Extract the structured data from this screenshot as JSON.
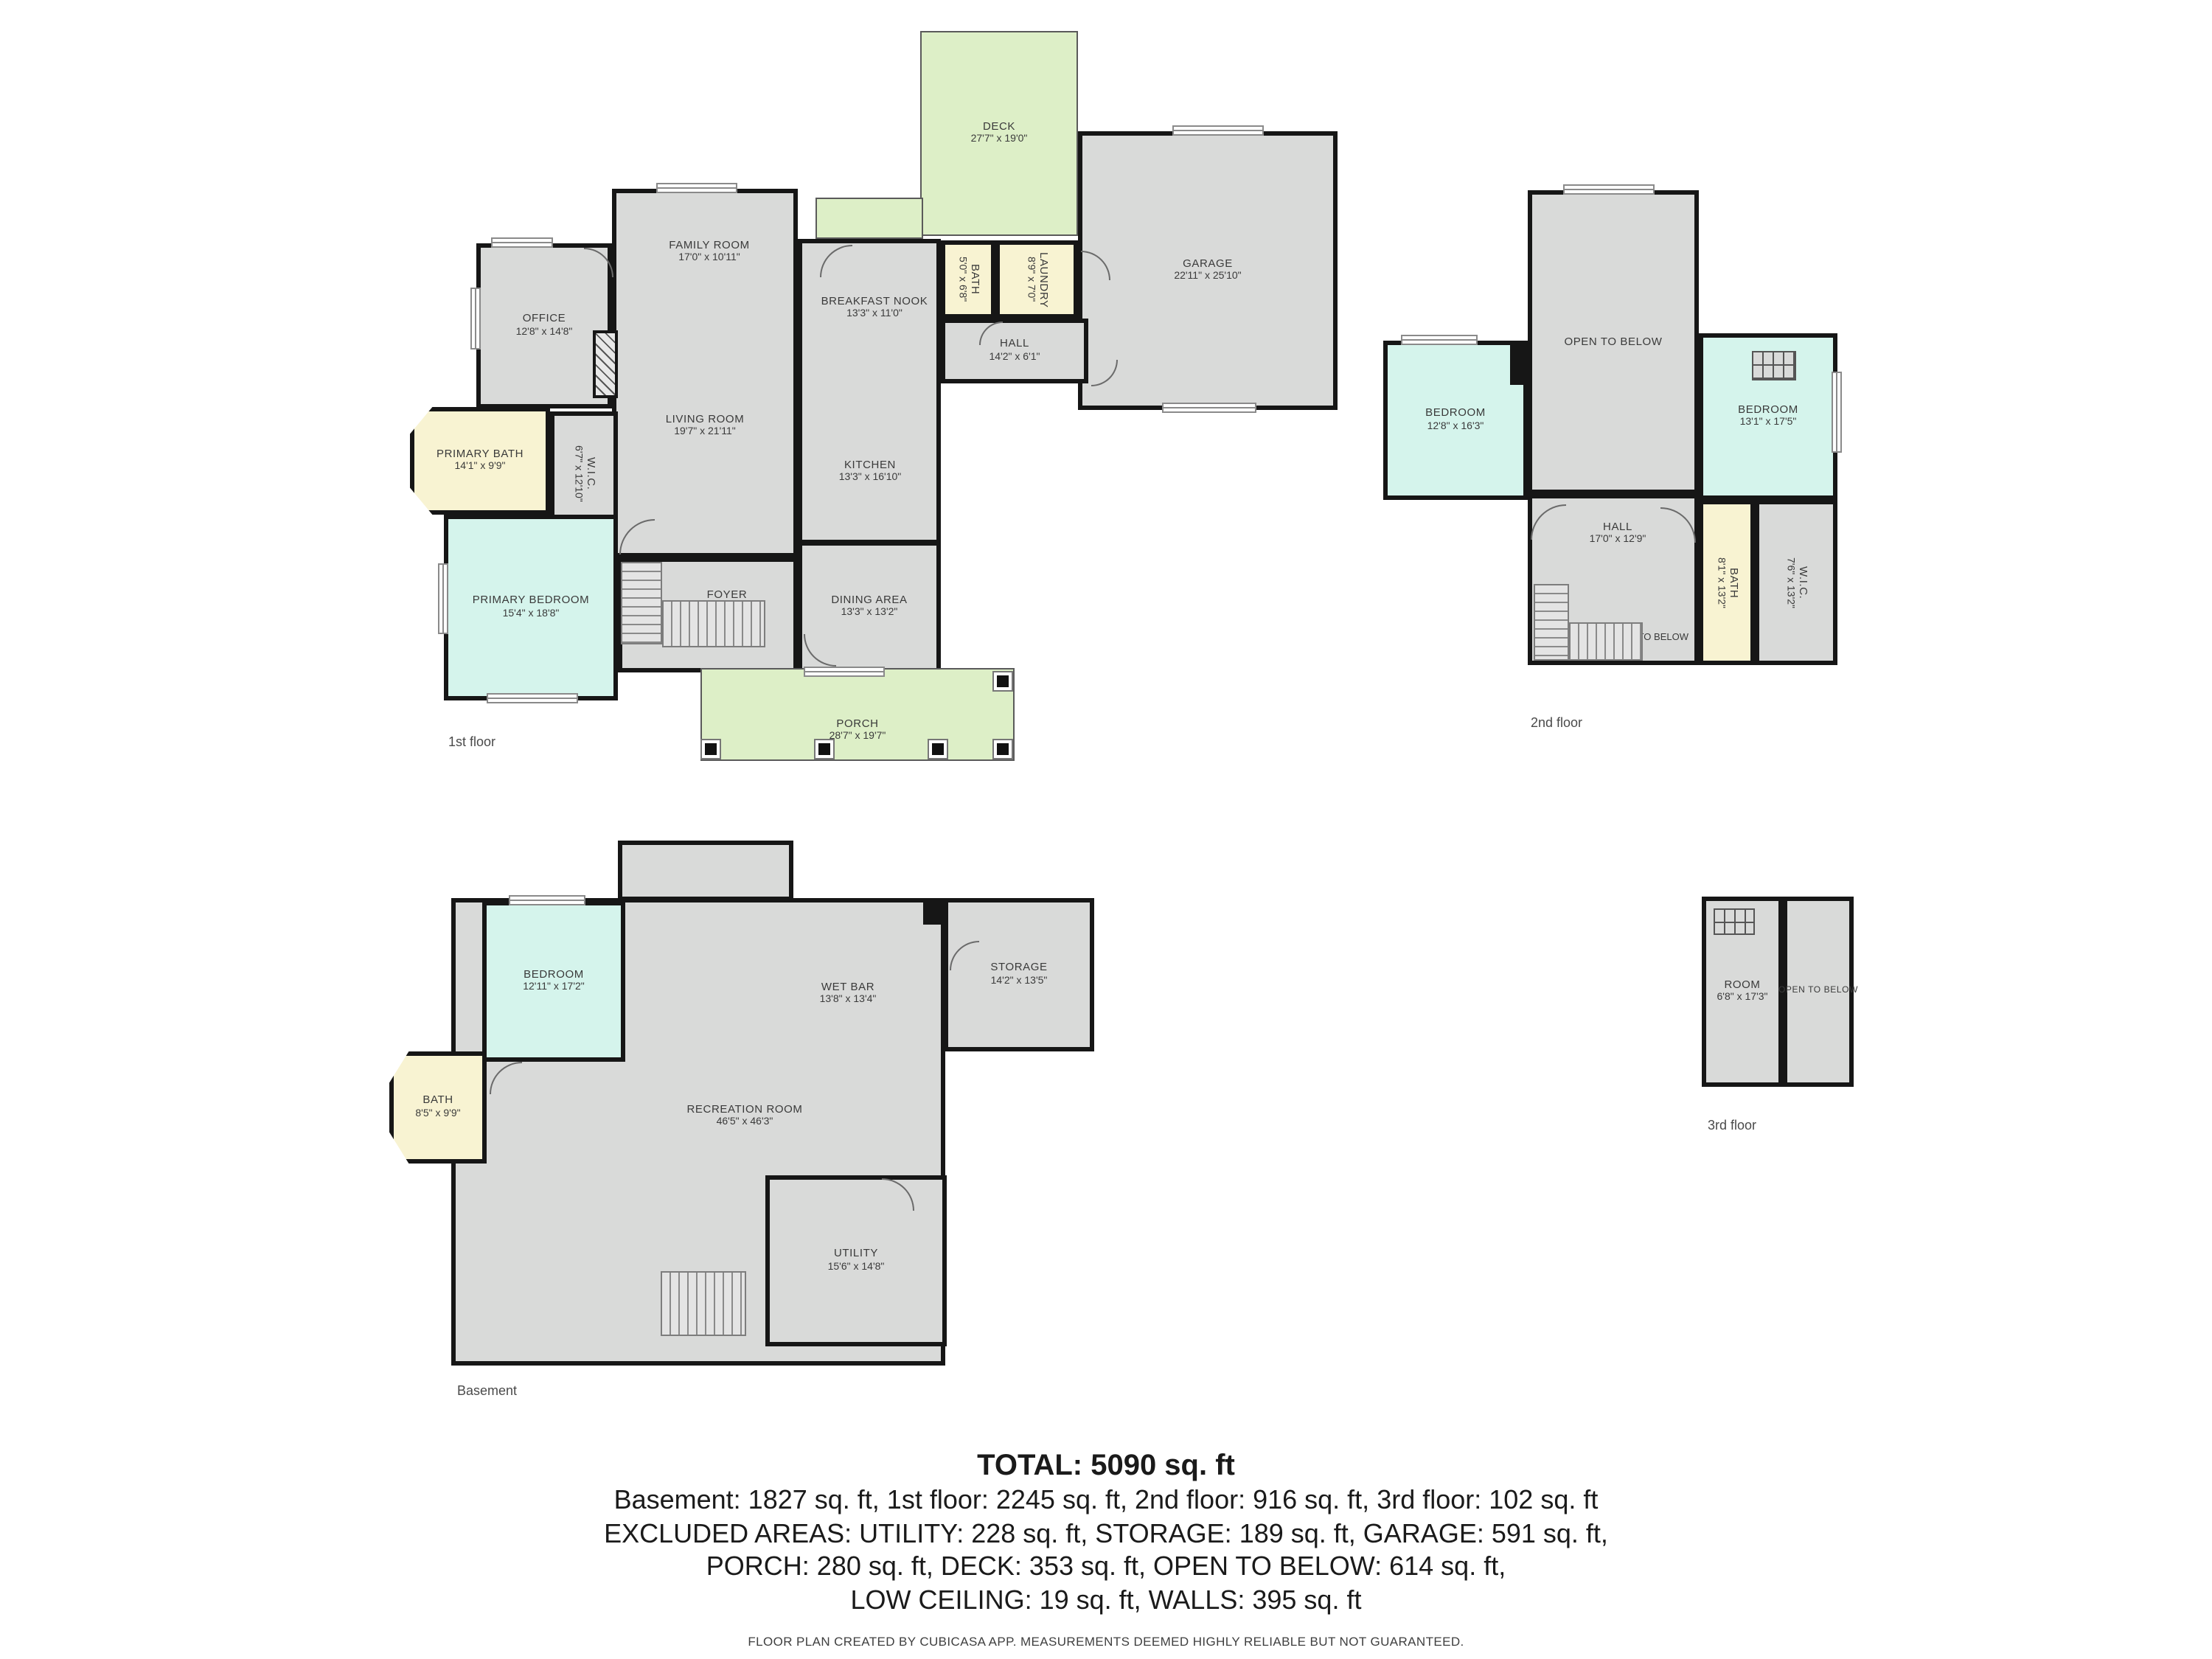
{
  "colors": {
    "wall": "#161616",
    "room_fill": "#d9dad9",
    "bedroom_fill": "#d5f4ec",
    "bath_fill": "#f8f3d2",
    "outdoor_fill": "#ddefc7",
    "label_text": "#3a3a3a"
  },
  "floors": {
    "f1": {
      "label": "1st floor",
      "rooms": {
        "deck": {
          "name": "DECK",
          "dims": "27'7\" x 19'0\""
        },
        "family": {
          "name": "FAMILY ROOM",
          "dims": "17'0\" x 10'11\""
        },
        "garage": {
          "name": "GARAGE",
          "dims": "22'11\" x 25'10\""
        },
        "office": {
          "name": "OFFICE",
          "dims": "12'8\" x 14'8\""
        },
        "breakfast": {
          "name": "BREAKFAST NOOK",
          "dims": "13'3\" x 11'0\""
        },
        "bath": {
          "name": "BATH",
          "dims": "5'0\" x 6'8\""
        },
        "laundry": {
          "name": "LAUNDRY",
          "dims": "8'9\" x 7'0\""
        },
        "hall": {
          "name": "HALL",
          "dims": "14'2\" x 6'1\""
        },
        "primary_bath": {
          "name": "PRIMARY BATH",
          "dims": "14'1\" x 9'9\""
        },
        "living": {
          "name": "LIVING ROOM",
          "dims": "19'7\" x 21'11\""
        },
        "wic": {
          "name": "W.I.C.",
          "dims": "6'7\" x 12'10\""
        },
        "kitchen": {
          "name": "KITCHEN",
          "dims": "13'3\" x 16'10\""
        },
        "primary_bedroom": {
          "name": "PRIMARY BEDROOM",
          "dims": "15'4\" x 18'8\""
        },
        "foyer": {
          "name": "FOYER",
          "dims": "15'0\" x 13'6\""
        },
        "dining": {
          "name": "DINING AREA",
          "dims": "13'3\" x 13'2\""
        },
        "porch": {
          "name": "PORCH",
          "dims": "28'7\" x 19'7\""
        }
      }
    },
    "f2": {
      "label": "2nd floor",
      "rooms": {
        "open_below": {
          "name": "OPEN TO BELOW"
        },
        "bedroom_left": {
          "name": "BEDROOM",
          "dims": "12'8\" x 16'3\""
        },
        "bedroom_right": {
          "name": "BEDROOM",
          "dims": "13'1\" x 17'5\""
        },
        "hall": {
          "name": "HALL",
          "dims": "17'0\" x 12'9\""
        },
        "open_below_lower": {
          "name": "OPEN TO BELOW"
        },
        "bath": {
          "name": "BATH",
          "dims": "8'1\" x 13'2\""
        },
        "wic": {
          "name": "W.I.C.",
          "dims": "7'6\" x 13'2\""
        }
      }
    },
    "bsmt": {
      "label": "Basement",
      "rooms": {
        "bedroom": {
          "name": "BEDROOM",
          "dims": "12'11\" x 17'2\""
        },
        "wet_bar": {
          "name": "WET BAR",
          "dims": "13'8\" x 13'4\""
        },
        "storage": {
          "name": "STORAGE",
          "dims": "14'2\" x 13'5\""
        },
        "bath": {
          "name": "BATH",
          "dims": "8'5\" x 9'9\""
        },
        "recreation": {
          "name": "RECREATION ROOM",
          "dims": "46'5\" x 46'3\""
        },
        "utility": {
          "name": "UTILITY",
          "dims": "15'6\" x 14'8\""
        }
      }
    },
    "f3": {
      "label": "3rd floor",
      "rooms": {
        "room": {
          "name": "ROOM",
          "dims": "6'8\" x 17'3\""
        },
        "open_below": {
          "name": "OPEN TO BELOW"
        }
      }
    }
  },
  "summary": {
    "total": "TOTAL: 5090 sq. ft",
    "lines": [
      "Basement: 1827 sq. ft, 1st floor: 2245 sq. ft, 2nd floor: 916 sq. ft, 3rd floor: 102 sq. ft",
      "EXCLUDED AREAS: UTILITY: 228 sq. ft, STORAGE: 189 sq. ft, GARAGE: 591 sq. ft,",
      "PORCH: 280 sq. ft, DECK: 353 sq. ft, OPEN TO BELOW: 614 sq. ft,",
      "LOW CEILING: 19 sq. ft, WALLS: 395 sq. ft"
    ],
    "disclaimer": "FLOOR PLAN CREATED BY CUBICASA APP. MEASUREMENTS DEEMED HIGHLY RELIABLE BUT NOT GUARANTEED."
  }
}
